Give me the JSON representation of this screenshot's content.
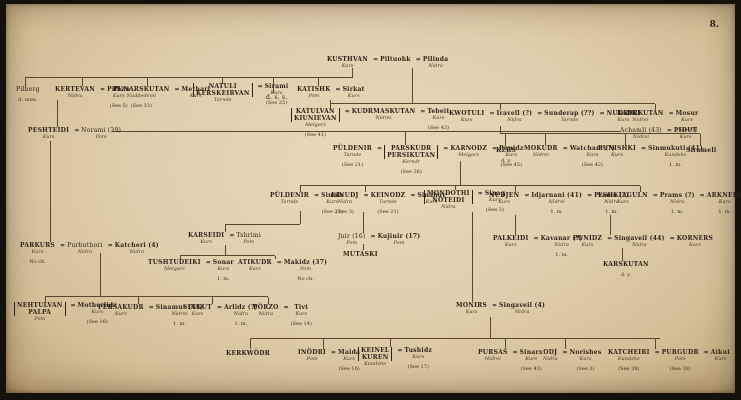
{
  "page": {
    "number": "8."
  },
  "palette": {
    "paper": "#e0cfae",
    "paper_edge": "#a98f66",
    "ink": "#2e2316",
    "line": "#5a4730"
  },
  "tree": {
    "nodes": [
      {
        "id": "kusthvan",
        "x": 327,
        "y": 56,
        "cols": [
          {
            "n": "KUSTHVAN",
            "c": "Kurs"
          },
          {
            "eq": true,
            "n": "Piltuohk"
          },
          {
            "eq": true,
            "n": "Pilinda",
            "c": "Nidra"
          }
        ]
      },
      {
        "id": "pilberg",
        "x": 16,
        "y": 86,
        "cols": [
          {
            "n": "Pilberg",
            "plain": true,
            "s": "d. unm."
          }
        ]
      },
      {
        "id": "kertevan",
        "x": 55,
        "y": 86,
        "cols": [
          {
            "n": "KERTEVAN",
            "c": "Nidra"
          },
          {
            "eq": true,
            "n": "Pilhan",
            "c": "Kurs",
            "s": "(See 5)"
          }
        ]
      },
      {
        "id": "punarskutan",
        "x": 113,
        "y": 86,
        "cols": [
          {
            "n": "PUNARSKUTAN",
            "c": "Nuddedemi",
            "s": "(See 33)"
          },
          {
            "eq": true,
            "n": "Methari",
            "c": "Kurs"
          }
        ]
      },
      {
        "id": "natuli",
        "x": 193,
        "y": 83,
        "cols": [
          {
            "stack": [
              "NATULI",
              "KERSKEIRVAN"
            ],
            "c": "Tarnde"
          },
          {
            "eq": true,
            "n": "Sirami",
            "c": "Kurs",
            "s": "(See 25)"
          }
        ]
      },
      {
        "id": "dss-note",
        "x": 266,
        "y": 94,
        "cols": [
          {
            "n": "d. s. s.",
            "plain": true
          }
        ]
      },
      {
        "id": "katishk",
        "x": 297,
        "y": 86,
        "cols": [
          {
            "n": "KATISHK",
            "c": "Pom"
          },
          {
            "eq": true,
            "n": "Sirkat",
            "c": "Kurs"
          }
        ]
      },
      {
        "id": "katulvan",
        "x": 291,
        "y": 108,
        "cols": [
          {
            "stack": [
              "KATULVAN",
              "KIUNIEVAN"
            ],
            "c": "Melgars",
            "s": "(See 41)"
          },
          {
            "eq": true,
            "n": "KUDRMASKUTAN",
            "c": "Nidrei"
          },
          {
            "eq": true,
            "n": "Tebeit",
            "c": "Kurs",
            "s": "(See 43)"
          }
        ]
      },
      {
        "id": "kwotuli",
        "x": 449,
        "y": 110,
        "cols": [
          {
            "n": "KWOTULI",
            "c": "Kurs"
          },
          {
            "eq": true,
            "n": "Iravell (?)",
            "c": "Nidra"
          },
          {
            "eq": true,
            "n": "Sunderap (??)",
            "c": "Tarnde"
          },
          {
            "eq": true,
            "n": "NUDRIKI",
            "c": "Kurs"
          }
        ]
      },
      {
        "id": "kadrkutan",
        "x": 617,
        "y": 110,
        "cols": [
          {
            "n": "KADRKUTAN",
            "c": "Nidrei"
          },
          {
            "eq": true,
            "n": "Mosur",
            "c": "Kurs",
            "s": "(See 49)"
          }
        ]
      },
      {
        "id": "peshteidi",
        "x": 28,
        "y": 127,
        "cols": [
          {
            "n": "PESHTEIDI",
            "c": "Kurs"
          },
          {
            "eq": true,
            "n": "Norami (39)",
            "c": "Pom",
            "plain": true
          }
        ]
      },
      {
        "id": "achamli",
        "x": 620,
        "y": 127,
        "cols": [
          {
            "n": "Achamli (43)",
            "c": "Nidrei",
            "plain": true
          },
          {
            "eq": true,
            "n": "PIDUT",
            "c": "Kurs"
          }
        ]
      },
      {
        "id": "puldenir-parskudr",
        "x": 333,
        "y": 145,
        "cols": [
          {
            "n": "PÜLDENIR",
            "c": "Tarnde",
            "s": "(See 21)"
          },
          {
            "eq": true,
            "stack": [
              "PARSKUDR",
              "PERSIKUTAN"
            ],
            "c": "Kerndr",
            "s": "(See 26)"
          },
          {
            "eq": true,
            "n": "KARNODZ",
            "c": "Melgars"
          },
          {
            "eq": true,
            "n": "Punidz",
            "c": "Kurs",
            "s": "(See 45)"
          }
        ]
      },
      {
        "id": "kers",
        "x": 496,
        "y": 147,
        "cols": [
          {
            "n": "KERS",
            "s": "d. y."
          }
        ]
      },
      {
        "id": "mokudr",
        "x": 524,
        "y": 145,
        "cols": [
          {
            "n": "MOKUDR",
            "c": "Nidrei"
          },
          {
            "eq": true,
            "n": "Watcham (?)",
            "c": "Kurs",
            "s": "(See 42)"
          }
        ]
      },
      {
        "id": "punishki",
        "x": 598,
        "y": 145,
        "cols": [
          {
            "n": "PUNISHKI",
            "c": "Kurs"
          },
          {
            "eq": true,
            "n": "Sinmukuti (41)",
            "c": "Kundshe",
            "s": "1. m."
          }
        ]
      },
      {
        "id": "siramell",
        "x": 686,
        "y": 147,
        "cols": [
          {
            "n": "Siramell"
          }
        ]
      },
      {
        "id": "puldenir2",
        "x": 270,
        "y": 192,
        "cols": [
          {
            "n": "PÜLDENIR",
            "c": "Tarnde"
          },
          {
            "eq": true,
            "n": "Sinnir",
            "c": "Kurs",
            "s": "(See 21)"
          }
        ]
      },
      {
        "id": "einudj",
        "x": 331,
        "y": 192,
        "cols": [
          {
            "n": "EINUDJ",
            "c": "Nidra",
            "s": "(See 3)"
          },
          {
            "eq": true,
            "n": "KEINODZ",
            "c": "Tarnde",
            "s": "(See 21)"
          },
          {
            "eq": true,
            "n": "Sinabuv",
            "c": "Kurs"
          }
        ]
      },
      {
        "id": "mondothi",
        "x": 424,
        "y": 190,
        "cols": [
          {
            "stack": [
              "MONDOTHI",
              "NOTEIDI"
            ],
            "c": "Nidra"
          },
          {
            "eq": true,
            "n": "Sinag",
            "c": "Kurs",
            "s": "(See 3)"
          }
        ]
      },
      {
        "id": "nudjen",
        "x": 489,
        "y": 192,
        "cols": [
          {
            "n": "NUDJEN",
            "c": "Kurs"
          },
          {
            "eq": true,
            "n": "Idjarnani (41)",
            "c": "Nidrei",
            "s": "1. m."
          },
          {
            "eq": true,
            "n": "Prams (?)",
            "c": "Nidra",
            "s": "1. m."
          }
        ]
      },
      {
        "id": "eshkiaguln",
        "x": 598,
        "y": 192,
        "cols": [
          {
            "n": "ESHKIAGULN",
            "c": "Kurs"
          },
          {
            "eq": true,
            "n": "Prams (?)",
            "c": "Nidra",
            "s": "1. m."
          },
          {
            "eq": true,
            "n": "ARKNERS",
            "c": "Kurs",
            "s": "1. m."
          }
        ]
      },
      {
        "id": "parkurs",
        "x": 20,
        "y": 242,
        "cols": [
          {
            "n": "PARKURS",
            "c": "Kurs",
            "s": "No ch."
          },
          {
            "eq": true,
            "n": "Purbuthori",
            "c": "Nidra",
            "plain": true
          },
          {
            "eq": true,
            "n": "Katcheri (4)",
            "c": "Nidra"
          }
        ]
      },
      {
        "id": "karseidi",
        "x": 188,
        "y": 232,
        "cols": [
          {
            "n": "KARSEIDI",
            "c": "Kurs"
          },
          {
            "eq": true,
            "n": "Tshrimi",
            "c": "Pom",
            "plain": true
          }
        ]
      },
      {
        "id": "jnir",
        "x": 338,
        "y": 233,
        "cols": [
          {
            "n": "Jnir (16)",
            "c": "Pom",
            "plain": true
          },
          {
            "eq": true,
            "n": "Kujinir (17)",
            "c": "Pom"
          }
        ]
      },
      {
        "id": "mutaski",
        "x": 343,
        "y": 251,
        "cols": [
          {
            "n": "MUTASKI"
          }
        ]
      },
      {
        "id": "palkeidi",
        "x": 493,
        "y": 235,
        "cols": [
          {
            "n": "PALKEIDI",
            "c": "Kurs"
          },
          {
            "eq": true,
            "n": "Kavanar (?)",
            "c": "Nidra",
            "s": "1. m."
          }
        ]
      },
      {
        "id": "punidz",
        "x": 573,
        "y": 235,
        "cols": [
          {
            "n": "PUNIDZ",
            "c": "Kurs"
          },
          {
            "eq": true,
            "n": "Singaveil (44)",
            "c": "Nidra"
          },
          {
            "eq": true,
            "n": "KORNERS",
            "c": "Kurs"
          }
        ]
      },
      {
        "id": "karskutan",
        "x": 603,
        "y": 261,
        "cols": [
          {
            "n": "KARSKUTAN",
            "s": "d. y."
          }
        ]
      },
      {
        "id": "tushtudeiki",
        "x": 148,
        "y": 259,
        "cols": [
          {
            "n": "TUSHTUDEIKI",
            "c": "Melgars"
          },
          {
            "eq": true,
            "n": "Sonar",
            "c": "Kurs",
            "s": "1. m."
          }
        ]
      },
      {
        "id": "atikudr",
        "x": 238,
        "y": 259,
        "cols": [
          {
            "n": "ATIKUDR",
            "c": "Kurs"
          },
          {
            "eq": true,
            "n": "Makidz (37)",
            "c": "Pom",
            "s": "No ch."
          }
        ]
      },
      {
        "id": "nehtulvan",
        "x": 14,
        "y": 302,
        "cols": [
          {
            "stack": [
              "NEHTULVAN",
              "PALPA"
            ],
            "c": "Pom"
          },
          {
            "eq": true,
            "n": "Motherlidz",
            "c": "Kurs",
            "s": "(See 16)"
          }
        ]
      },
      {
        "id": "persakudr",
        "x": 98,
        "y": 304,
        "cols": [
          {
            "n": "PERSAKUDR",
            "c": "Kurs"
          },
          {
            "eq": true,
            "n": "Sinamut (43)",
            "c": "Nidrei",
            "s": "1. m."
          }
        ]
      },
      {
        "id": "singut",
        "x": 183,
        "y": 304,
        "cols": [
          {
            "n": "SINGUT",
            "c": "Kurs"
          },
          {
            "eq": true,
            "n": "Arlidz (?)",
            "c": "Nidra",
            "s": "1. m."
          }
        ]
      },
      {
        "id": "porzo",
        "x": 253,
        "y": 304,
        "cols": [
          {
            "n": "PÖRZO",
            "c": "Nidra"
          },
          {
            "eq": true,
            "n": "Tivt",
            "c": "Kurs",
            "s": "(See 14)"
          }
        ]
      },
      {
        "id": "monirs",
        "x": 456,
        "y": 302,
        "cols": [
          {
            "n": "MONIRS",
            "c": "Kurs"
          },
          {
            "eq": true,
            "n": "Singaveil (4)",
            "c": "Nidra"
          }
        ]
      },
      {
        "id": "kerkwodr",
        "x": 226,
        "y": 350,
        "cols": [
          {
            "n": "KERKWÖDR"
          }
        ]
      },
      {
        "id": "inodri",
        "x": 298,
        "y": 349,
        "cols": [
          {
            "n": "INÖDRI",
            "c": "Pom"
          },
          {
            "eq": true,
            "n": "Maida",
            "c": "Kurs",
            "s": "(See 16)"
          }
        ]
      },
      {
        "id": "keinel",
        "x": 358,
        "y": 347,
        "cols": [
          {
            "stack": [
              "KEINEL",
              "KUREN"
            ],
            "c": "Kundshe"
          },
          {
            "eq": true,
            "n": "Tushidz",
            "c": "Kurs",
            "s": "(See 17)"
          }
        ]
      },
      {
        "id": "pursas",
        "x": 478,
        "y": 349,
        "cols": [
          {
            "n": "PURSAS",
            "c": "Nidrei"
          },
          {
            "eq": true,
            "n": "Sinarx",
            "c": "Kurs",
            "s": "(See 41)"
          }
        ]
      },
      {
        "id": "odj",
        "x": 543,
        "y": 349,
        "cols": [
          {
            "n": "ODJ",
            "c": "Nidra"
          },
          {
            "eq": true,
            "n": "Norishes",
            "c": "Kurs",
            "s": "(See 3)"
          }
        ]
      },
      {
        "id": "katcheiri",
        "x": 608,
        "y": 349,
        "cols": [
          {
            "n": "KATCHEIRI",
            "c": "Kundshe",
            "s": "(See 28)"
          },
          {
            "eq": true,
            "n": "PURGUDR",
            "c": "Pom",
            "s": "(See 38)"
          },
          {
            "eq": true,
            "n": "Aikut",
            "c": "Kurs"
          }
        ]
      }
    ],
    "connectors": [
      [
        352,
        68,
        1,
        9
      ],
      [
        25,
        77,
        328,
        1
      ],
      [
        25,
        78,
        1,
        8
      ],
      [
        82,
        78,
        1,
        8
      ],
      [
        147,
        78,
        1,
        8
      ],
      [
        222,
        78,
        1,
        6
      ],
      [
        273,
        78,
        1,
        15
      ],
      [
        318,
        78,
        1,
        8
      ],
      [
        412,
        68,
        1,
        35
      ],
      [
        330,
        103,
        325,
        1
      ],
      [
        330,
        100,
        1,
        8
      ],
      [
        500,
        104,
        1,
        6
      ],
      [
        655,
        104,
        1,
        6
      ],
      [
        57,
        100,
        1,
        27
      ],
      [
        112,
        131,
        508,
        1
      ],
      [
        405,
        132,
        1,
        13
      ],
      [
        500,
        126,
        1,
        7
      ],
      [
        500,
        133,
        200,
        1
      ],
      [
        505,
        134,
        1,
        12
      ],
      [
        545,
        134,
        1,
        11
      ],
      [
        625,
        134,
        1,
        11
      ],
      [
        700,
        134,
        1,
        12
      ],
      [
        460,
        161,
        1,
        24
      ],
      [
        300,
        185,
        340,
        1
      ],
      [
        300,
        186,
        1,
        6
      ],
      [
        365,
        186,
        1,
        6
      ],
      [
        455,
        186,
        1,
        4
      ],
      [
        515,
        186,
        1,
        6
      ],
      [
        640,
        186,
        1,
        6
      ],
      [
        50,
        141,
        1,
        101
      ],
      [
        300,
        211,
        1,
        13
      ],
      [
        225,
        224,
        75,
        1
      ],
      [
        225,
        225,
        1,
        7
      ],
      [
        225,
        245,
        1,
        10
      ],
      [
        180,
        255,
        95,
        1
      ],
      [
        180,
        256,
        1,
        3
      ],
      [
        275,
        256,
        1,
        3
      ],
      [
        363,
        212,
        1,
        21
      ],
      [
        363,
        244,
        1,
        6
      ],
      [
        622,
        248,
        1,
        13
      ],
      [
        515,
        215,
        1,
        20
      ],
      [
        610,
        215,
        1,
        20
      ],
      [
        100,
        253,
        1,
        43
      ],
      [
        45,
        296,
        223,
        1
      ],
      [
        45,
        297,
        1,
        5
      ],
      [
        138,
        297,
        1,
        7
      ],
      [
        212,
        297,
        1,
        7
      ],
      [
        268,
        297,
        1,
        7
      ],
      [
        472,
        212,
        1,
        90
      ],
      [
        490,
        317,
        1,
        21
      ],
      [
        250,
        338,
        410,
        1
      ],
      [
        250,
        339,
        1,
        10
      ],
      [
        323,
        339,
        1,
        10
      ],
      [
        390,
        339,
        1,
        8
      ],
      [
        505,
        339,
        1,
        10
      ],
      [
        565,
        339,
        1,
        10
      ],
      [
        655,
        339,
        1,
        10
      ]
    ]
  }
}
